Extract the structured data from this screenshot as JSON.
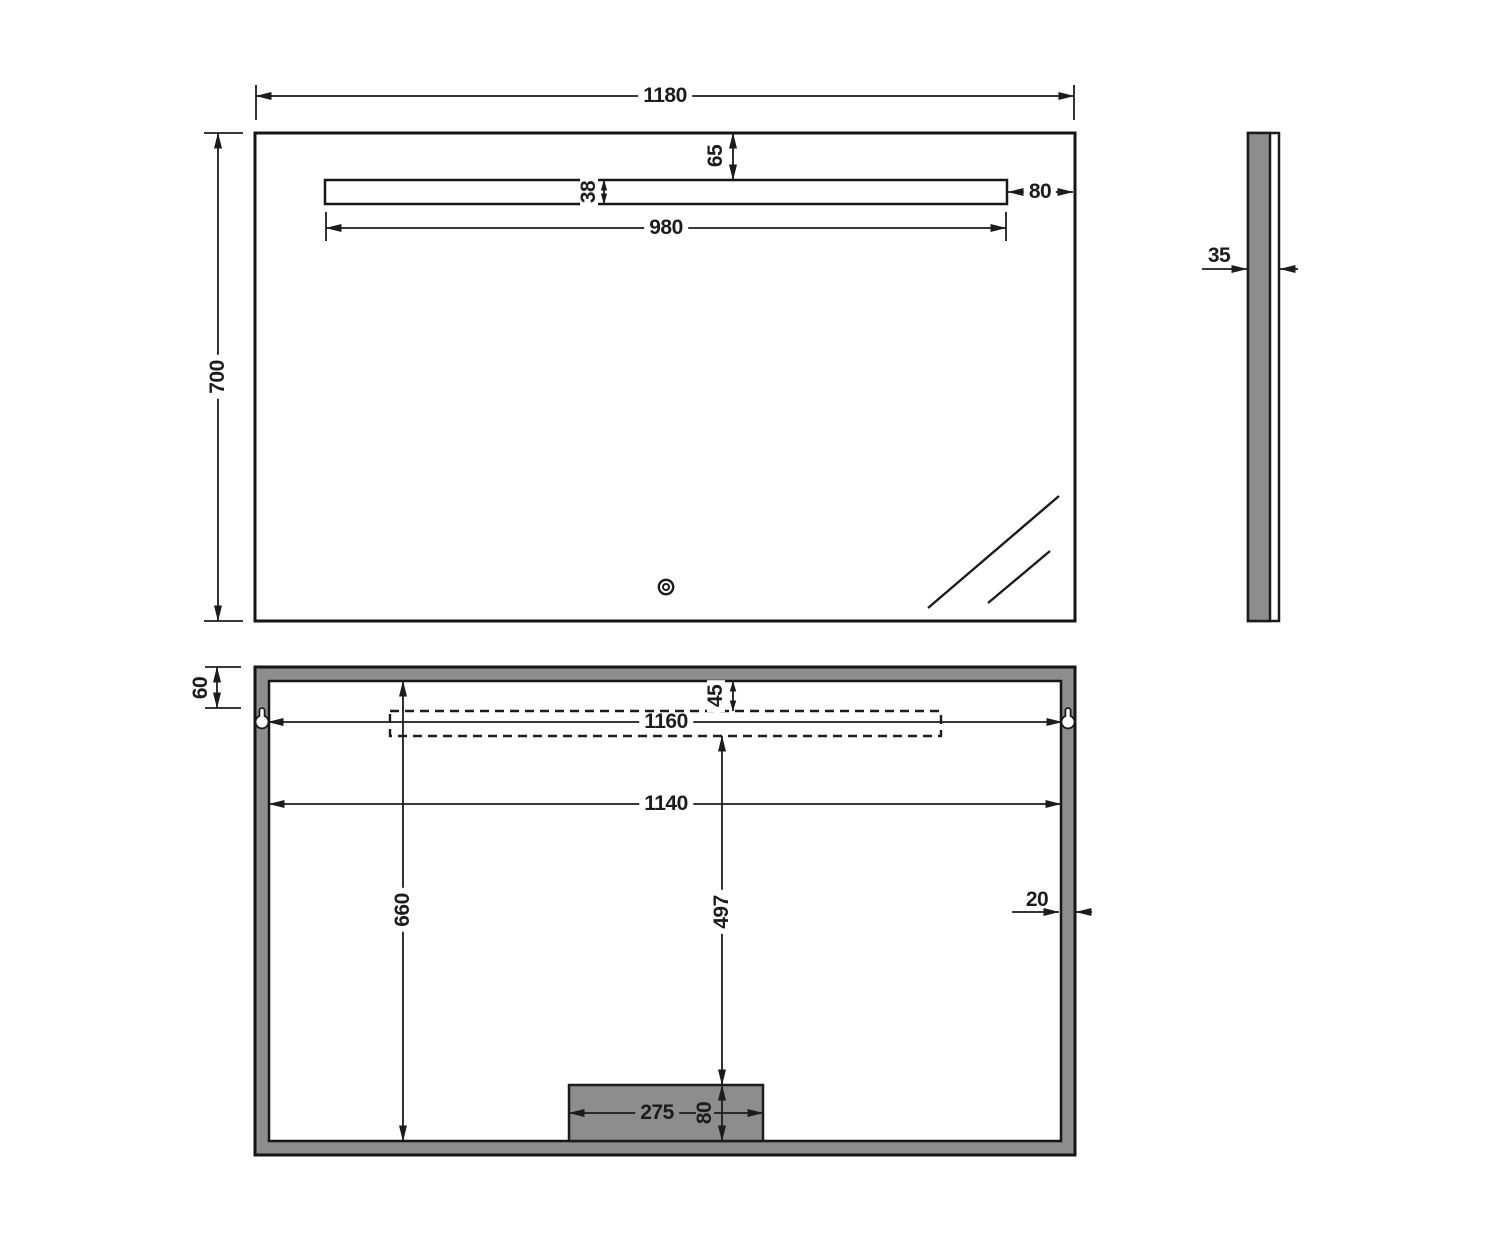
{
  "front_view": {
    "overall_width": "1180",
    "overall_height": "700",
    "light_top_offset": "65",
    "light_strip_height": "38",
    "light_strip_width": "980",
    "light_right_offset": "80"
  },
  "side_view": {
    "thickness": "35"
  },
  "back_view": {
    "hanger_top_offset": "60",
    "led_top_offset": "45",
    "hanger_spacing": "1160",
    "mounting_width": "1140",
    "mounting_height": "660",
    "junction_center_offset": "497",
    "junction_box_width": "275",
    "junction_box_height": "80",
    "frame_thickness": "20"
  },
  "colors": {
    "frame_gray": "#8d8d8d",
    "line_dark": "#1c1c1c"
  }
}
